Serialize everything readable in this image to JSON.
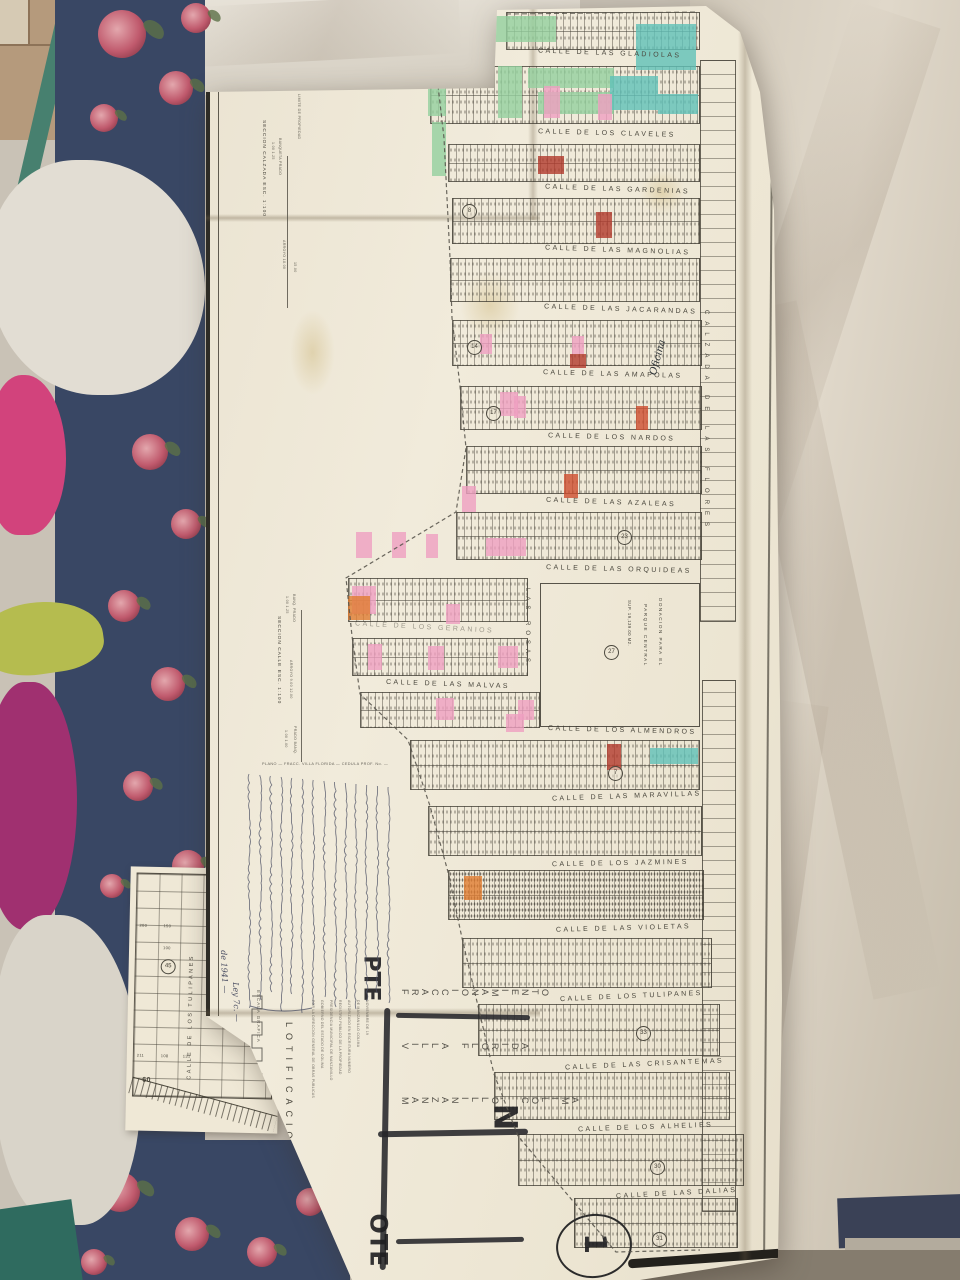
{
  "scene": {
    "floor_color": "#b59a7c",
    "bedframe_color": "#47806f",
    "floral_fabric_color": "#394764",
    "pink_garment_color": "#d2437c",
    "magenta_garment_color": "#a03070",
    "green_item_color": "#b5bc4f",
    "sheet_color": "#e3dccd",
    "roses": [
      [
        122,
        34,
        24
      ],
      [
        176,
        88,
        17
      ],
      [
        104,
        118,
        14
      ],
      [
        196,
        18,
        15
      ],
      [
        150,
        452,
        18
      ],
      [
        186,
        524,
        15
      ],
      [
        124,
        606,
        16
      ],
      [
        168,
        684,
        17
      ],
      [
        138,
        786,
        15
      ],
      [
        188,
        866,
        16
      ],
      [
        112,
        886,
        12
      ],
      [
        120,
        1192,
        20
      ],
      [
        192,
        1234,
        17
      ],
      [
        262,
        1252,
        15
      ],
      [
        310,
        1202,
        14
      ],
      [
        94,
        1262,
        13
      ]
    ]
  },
  "sheet": {
    "streets": [
      {
        "t": "CALLE DE LAS GLADIOLAS",
        "x": 538,
        "y": 50,
        "r": 2
      },
      {
        "t": "CALLE DE LOS CLAVELES",
        "x": 538,
        "y": 130,
        "r": 1.5
      },
      {
        "t": "CALLE DE LAS GARDENIAS",
        "x": 545,
        "y": 186,
        "r": 2
      },
      {
        "t": "CALLE DE LAS MAGNOLIAS",
        "x": 545,
        "y": 247,
        "r": 2
      },
      {
        "t": "CALLE DE LAS JACARANDAS",
        "x": 544,
        "y": 306,
        "r": 2
      },
      {
        "t": "CALLE DE LAS AMAPOLAS",
        "x": 543,
        "y": 371,
        "r": 1.5
      },
      {
        "t": "CALLE DE LOS NARDOS",
        "x": 548,
        "y": 434,
        "r": 1.5
      },
      {
        "t": "CALLE DE LAS AZALEAS",
        "x": 546,
        "y": 499,
        "r": 2
      },
      {
        "t": "CALLE DE LAS ORQUIDEAS",
        "x": 546,
        "y": 566,
        "r": 1.5
      },
      {
        "t": "CALLE DE LOS GERANIOS",
        "x": 355,
        "y": 624,
        "r": 3,
        "f": 1
      },
      {
        "t": "CALLE DE LAS MALVAS",
        "x": 386,
        "y": 681,
        "r": 2
      },
      {
        "t": "CALLE DE LOS ALMENDROS",
        "x": 548,
        "y": 727,
        "r": 1.5
      },
      {
        "t": "CALLE DE LAS MARAVILLAS",
        "x": 552,
        "y": 793,
        "r": -2
      },
      {
        "t": "CALLE DE LOS JAZMINES",
        "x": 552,
        "y": 860,
        "r": -1
      },
      {
        "t": "CALLE DE LAS VIOLETAS",
        "x": 556,
        "y": 925,
        "r": -1.5
      },
      {
        "t": "CALLE DE LOS TULIPANES",
        "x": 560,
        "y": 993,
        "r": -2.5
      },
      {
        "t": "CALLE DE LAS CRISANTEMAS",
        "x": 565,
        "y": 1061,
        "r": -2.5
      },
      {
        "t": "CALLE DE LOS ALHELIES",
        "x": 578,
        "y": 1124,
        "r": -2
      },
      {
        "t": "CALLE DE LAS DALIAS",
        "x": 616,
        "y": 1190,
        "r": -3
      }
    ],
    "blocks": [
      [
        506,
        12,
        192,
        36
      ],
      [
        430,
        66,
        268,
        56
      ],
      [
        448,
        144,
        250,
        36
      ],
      [
        452,
        198,
        246,
        44
      ],
      [
        450,
        258,
        248,
        42
      ],
      [
        452,
        320,
        248,
        44
      ],
      [
        460,
        386,
        240,
        42
      ],
      [
        466,
        446,
        234,
        46
      ],
      [
        456,
        512,
        244,
        46
      ],
      [
        348,
        578,
        178,
        42
      ],
      [
        352,
        638,
        174,
        36
      ],
      [
        360,
        692,
        178,
        34
      ],
      [
        410,
        740,
        288,
        48
      ],
      [
        428,
        806,
        272,
        48
      ],
      [
        448,
        870,
        254,
        48,
        "dense"
      ],
      [
        462,
        938,
        248,
        48
      ],
      [
        478,
        1004,
        240,
        50
      ],
      [
        494,
        1072,
        234,
        46
      ],
      [
        518,
        1134,
        224,
        50
      ],
      [
        574,
        1198,
        162,
        48
      ],
      [
        700,
        60,
        34,
        560,
        "sparse"
      ],
      [
        702,
        680,
        32,
        530,
        "sparse"
      ]
    ],
    "lots": [
      [
        434,
        16,
        56,
        26,
        "#93cf9d"
      ],
      [
        492,
        16,
        64,
        26,
        "#93cf9d"
      ],
      [
        428,
        60,
        18,
        56,
        "#93cf9d"
      ],
      [
        498,
        66,
        24,
        52,
        "#93cf9d"
      ],
      [
        528,
        68,
        86,
        20,
        "#93cf9d"
      ],
      [
        538,
        92,
        76,
        22,
        "#93cf9d"
      ],
      [
        432,
        122,
        14,
        54,
        "#93cf9d"
      ],
      [
        636,
        24,
        60,
        46,
        "#5fc0b8"
      ],
      [
        610,
        76,
        48,
        34,
        "#5fc0b8"
      ],
      [
        658,
        94,
        40,
        20,
        "#5fc0b8"
      ],
      [
        650,
        748,
        48,
        16,
        "#5fc0b8"
      ],
      [
        544,
        86,
        16,
        32,
        "#ef9fc0"
      ],
      [
        598,
        94,
        14,
        26,
        "#ef9fc0"
      ],
      [
        572,
        336,
        12,
        18,
        "#ef9fc0"
      ],
      [
        480,
        334,
        12,
        20,
        "#ef9fc0"
      ],
      [
        500,
        392,
        18,
        24,
        "#ef9fc0"
      ],
      [
        514,
        396,
        12,
        22,
        "#ef9fc0"
      ],
      [
        462,
        486,
        14,
        26,
        "#ef9fc0"
      ],
      [
        486,
        538,
        40,
        18,
        "#ef9fc0"
      ],
      [
        356,
        532,
        16,
        26,
        "#ef9fc0"
      ],
      [
        392,
        532,
        14,
        26,
        "#ef9fc0"
      ],
      [
        426,
        534,
        12,
        24,
        "#ef9fc0"
      ],
      [
        352,
        586,
        24,
        28,
        "#ef9fc0"
      ],
      [
        368,
        644,
        14,
        26,
        "#ef9fc0"
      ],
      [
        428,
        646,
        16,
        24,
        "#ef9fc0"
      ],
      [
        498,
        646,
        20,
        22,
        "#ef9fc0"
      ],
      [
        446,
        604,
        14,
        20,
        "#ef9fc0"
      ],
      [
        436,
        698,
        18,
        22,
        "#ef9fc0"
      ],
      [
        518,
        700,
        16,
        20,
        "#ef9fc0"
      ],
      [
        506,
        714,
        18,
        18,
        "#ef9fc0"
      ],
      [
        538,
        156,
        26,
        18,
        "#b23a2c"
      ],
      [
        596,
        212,
        16,
        26,
        "#b23a2c"
      ],
      [
        570,
        354,
        16,
        14,
        "#b23a2c"
      ],
      [
        607,
        744,
        14,
        26,
        "#b23a2c"
      ],
      [
        636,
        406,
        12,
        24,
        "#cd4c2e"
      ],
      [
        564,
        474,
        14,
        24,
        "#cd4c2e"
      ],
      [
        464,
        876,
        18,
        24,
        "#e07c31"
      ],
      [
        348,
        596,
        22,
        24,
        "#e07c31"
      ]
    ],
    "circles": [
      [
        462,
        204,
        "8"
      ],
      [
        467,
        340,
        "14"
      ],
      [
        486,
        406,
        "17"
      ],
      [
        617,
        530,
        "23"
      ],
      [
        608,
        766,
        "7"
      ],
      [
        636,
        1026,
        "33"
      ],
      [
        650,
        1160,
        "30"
      ],
      [
        652,
        1232,
        "31"
      ]
    ],
    "verticals": [
      {
        "t": "CALZADA  DE  LAS  FLORES",
        "x": 703,
        "y": 310,
        "s": 6,
        "ls": 7
      },
      {
        "t": "LAS  ROSAS",
        "x": 524,
        "y": 588,
        "s": 6,
        "ls": 5
      },
      {
        "t": "LOTIFICACION",
        "x": 284,
        "y": 1022,
        "s": 9,
        "ls": 6
      },
      {
        "t": "DONACION  PARA  EL",
        "x": 658,
        "y": 598,
        "s": 4.6,
        "ls": 1.5
      },
      {
        "t": "PARQUE  CENTRAL",
        "x": 643,
        "y": 604,
        "s": 4.6,
        "ls": 1.5
      },
      {
        "t": "SUP. 19,139.00 M2.",
        "x": 627,
        "y": 600,
        "s": 4.2,
        "ls": 0.5
      }
    ],
    "parque": {
      "num": "27",
      "x": 540,
      "y": 583,
      "w": 158,
      "h": 142
    },
    "title": {
      "rows": [
        "FRACCIONAMIENTO",
        "VILLA  FLORIDA",
        "MANZANILLO,  COLIMA"
      ],
      "x": 400,
      "y": 984,
      "gap": 54,
      "cw": 10
    },
    "compass": {
      "n": "N",
      "pte": "PTE",
      "ote": "OTE"
    },
    "sheet_no": "1",
    "oficina": "Oficina",
    "frag1": "de 1941 —",
    "frag2": "Ley 7c. —",
    "print_line": "PLANO — FRACC. VILLA FLORIDA — CEDULA PROF. No. —",
    "escala_label": "ESCALA GRAFICA",
    "sections": [
      {
        "title": "SECCION CALZADA   ESC. 1:100",
        "tx": 261,
        "ty": 120,
        "line": [
          287,
          156,
          152
        ],
        "labels": [
          [
            "LIMITE DE PROPIEDAD",
            297,
            94
          ],
          [
            "BANQUETA  PRADO",
            278,
            138
          ],
          [
            "1.00  1.25",
            271,
            142
          ],
          [
            "ARROYO  18.00",
            282,
            240
          ],
          [
            "15.00",
            293,
            262
          ]
        ]
      },
      {
        "title": "SECCION CALLE   ESC. 1:100",
        "tx": 276,
        "ty": 616,
        "line": [
          301,
          610,
          152
        ],
        "labels": [
          [
            "BANQ. PRADO",
            292,
            594
          ],
          [
            "1.00  1.25",
            285,
            596
          ],
          [
            "ARROYO  9.00  12.00",
            289,
            660
          ],
          [
            "PRADO  BANQ.",
            293,
            726
          ],
          [
            "1.00  1.00",
            284,
            730
          ]
        ]
      }
    ],
    "cert_lines": [
      "POR LA DIRECCION GENERAL DE OBRAS PUBLICAS",
      "GOBIERNO DEL ESTADO DE COLIMA",
      "PRESIDENCIA MUNICIPAL DE MANZANILLO",
      "REGISTRO PUBLICO DE LA PROPIEDAD",
      "AUTORIZADO EN ESCRITURA NUMERO",
      "DE MANZANILLO COLIMA",
      "NOVIEMBRE DE 19"
    ],
    "boundary": [
      [
        430,
        16
      ],
      [
        444,
        138
      ],
      [
        450,
        258
      ],
      [
        452,
        318
      ],
      [
        460,
        386
      ],
      [
        466,
        448
      ],
      [
        456,
        512
      ],
      [
        346,
        578
      ],
      [
        352,
        636
      ],
      [
        360,
        694
      ],
      [
        408,
        740
      ],
      [
        430,
        806
      ],
      [
        448,
        872
      ],
      [
        462,
        938
      ],
      [
        478,
        1006
      ],
      [
        494,
        1074
      ],
      [
        518,
        1136
      ],
      [
        572,
        1200
      ],
      [
        616,
        1252
      ],
      [
        700,
        1250
      ]
    ],
    "top_edge": [
      [
        506,
        14
      ],
      [
        698,
        12
      ]
    ],
    "handwriting": {
      "x0": 249,
      "dx": 10.7,
      "lines": 14,
      "y0": 774,
      "y1": 1008
    }
  },
  "inset": {
    "street": "CALLE DE LOS TULIPANES",
    "circled": "45",
    "sixty": "60",
    "nums": [
      [
        "200",
        8,
        56
      ],
      [
        "150",
        32,
        56
      ],
      [
        "100",
        32,
        78
      ],
      [
        "211",
        8,
        186
      ],
      [
        "108",
        32,
        186
      ],
      [
        "131",
        54,
        186
      ]
    ]
  }
}
